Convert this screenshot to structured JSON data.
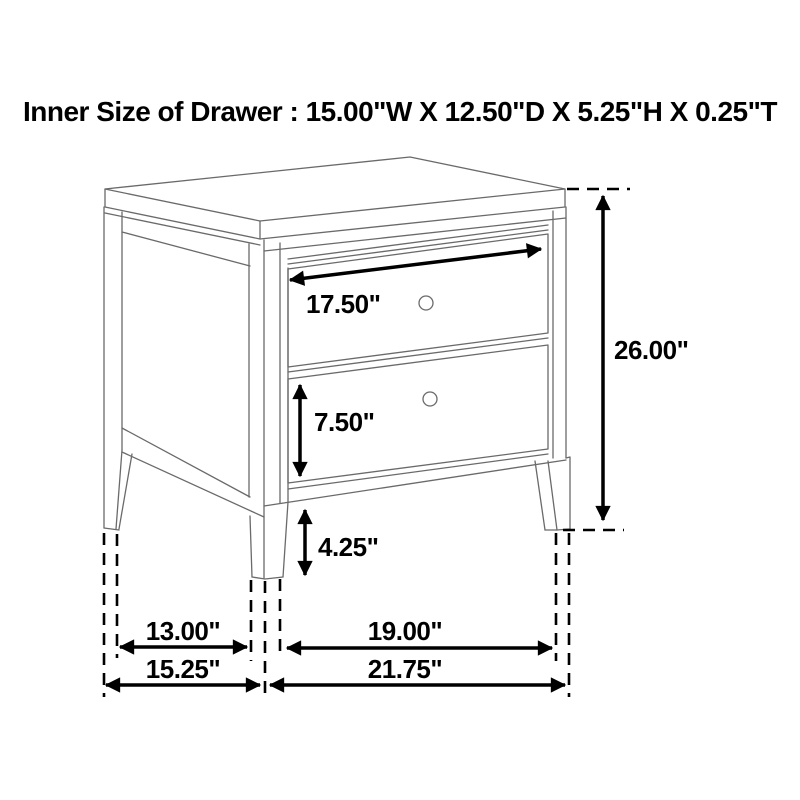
{
  "title": "Inner Size of Drawer : 15.00\"W X 12.50\"D X 5.25\"H X 0.25\"T",
  "inner_drawer_size": {
    "width": "15.00\"W",
    "depth": "12.50\"D",
    "height": "5.25\"H",
    "thickness": "0.25\"T"
  },
  "dimension_labels": {
    "top_drawer_width": "17.50\"",
    "bottom_drawer_height": "7.50\"",
    "leg_clearance": "4.25\"",
    "overall_height": "26.00\"",
    "side_leg_span_inner": "13.00\"",
    "front_leg_span_inner": "19.00\"",
    "overall_depth": "15.25\"",
    "overall_width": "21.75\""
  },
  "colors": {
    "background": "#ffffff",
    "furniture_line": "#6a6a6a",
    "dimension": "#000000"
  }
}
